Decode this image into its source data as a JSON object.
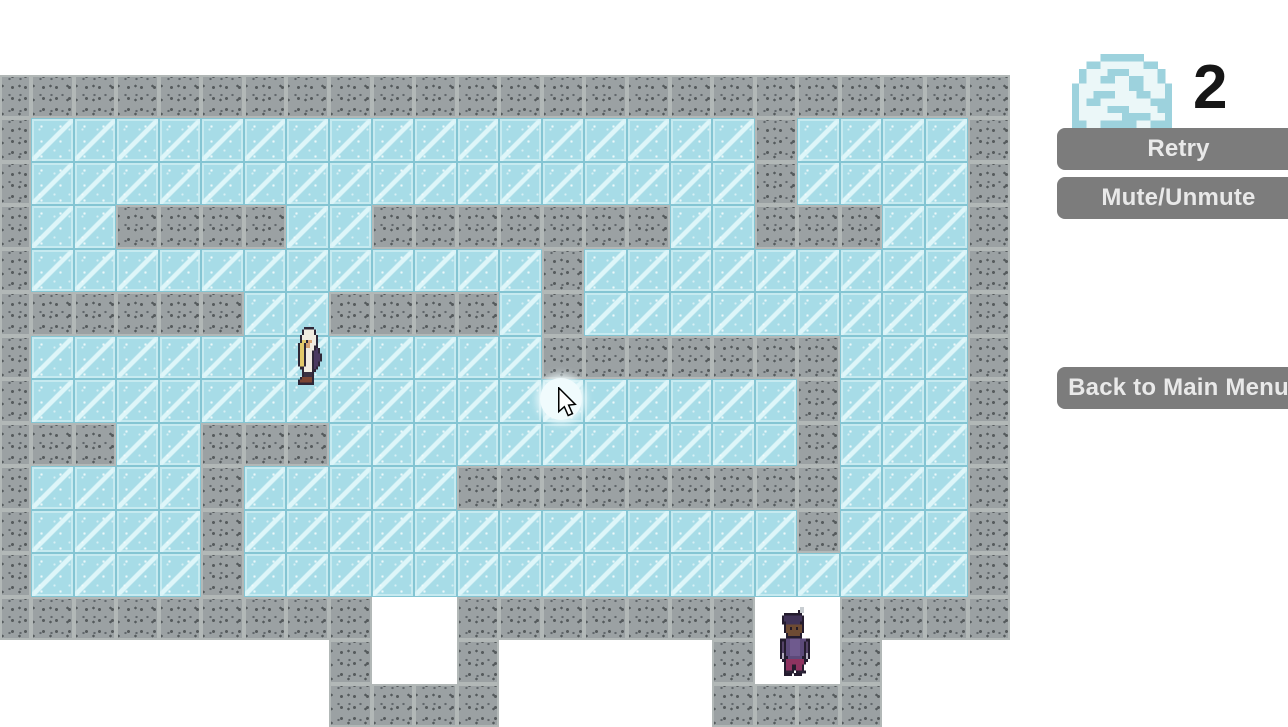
{
  "hud": {
    "level_number": "2",
    "buttons": [
      {
        "id": "retry",
        "label": "Retry"
      },
      {
        "id": "mute",
        "label": "Mute/Unmute"
      },
      {
        "id": "back",
        "label": "Back to Main Menu"
      }
    ],
    "button_color": "#7c7c7c",
    "button_text_color": "#e9e9e9",
    "level_icon": {
      "name": "ice-planet-icon",
      "x": 1072,
      "y": 54,
      "width": 100,
      "height": 74,
      "palette": {
        "B": "#9dd2dd",
        "W": "#ebf7f8"
      },
      "pixels": [
        "....BBBBBB....",
        "..BBWWWWWWBB..",
        ".BWWWBBBWWWWB.",
        ".BWWBBWWBBWWB.",
        "BWWWWWWWBBWWWB",
        "BWWBBBWWWBBWWB",
        "BWBBWWWWWWWBBB",
        "BWWWWBBBWWWWBB",
        "BWWWWWWBBBBWWB",
        "BBWWBBBBBWWBBB"
      ]
    }
  },
  "maze": {
    "origin": {
      "x": 0,
      "y": 75
    },
    "tile": {
      "width": 42.57,
      "height": 43.47,
      "first_col_width": 31
    },
    "legend": {
      "#": "wall",
      ".": "ice",
      " ": "empty"
    },
    "colors": {
      "wall": "#9ba1a3",
      "wall_edge": "#b2b8b7",
      "wall_speckle": "#565b5d",
      "ice": "#a7dce7",
      "ice_edge": "#84c5d3",
      "ice_streak": "#e1f7fa"
    },
    "map": [
      "########################",
      "#.................#....#",
      "#.................#....#",
      "#..####..#######..###..#",
      "#............#.........#",
      "######..####.#.........#",
      "#............#######...#",
      "#..................#...#",
      "###..###...........#...#",
      "#....#.....#########...#",
      "#....#.............#...#",
      "#....#.................#",
      "#########  #######  ####",
      "        #  #     #  #   ",
      "        ####     ####   "
    ]
  },
  "characters": {
    "player": {
      "name": "hooded-explorer",
      "x": 294,
      "y": 327,
      "width": 30,
      "height": 58,
      "palette": {
        "o": "#2e2737",
        "h": "#f1ece1",
        "y": "#e3c96a",
        "s": "#d6a272",
        "p": "#4a3960",
        "k": "#3a3142",
        "b": "#7c4533"
      },
      "pixels": [
        ".....ooooo.....",
        "....ohhhhho....",
        "....ohhhhho....",
        "...ohhhhhhho...",
        "...ohhhhhhho...",
        "...oyyosshho...",
        "..oyyosshhho...",
        "..oyyosshhoo...",
        "..oyyohhhhopo..",
        "..oyyohhhoppo..",
        "..oyyohhhopppo.",
        "..oyyohhhopppo.",
        "..oyyohhhopppo.",
        "..oyyohhhoppo..",
        "..oyyohhhoppo..",
        "...oohhhhopo...",
        "....ohhhhoo....",
        "....okkkko.....",
        "....okkkko.....",
        "...obbbbbo.....",
        "..obbbbbbo.....",
        "..oooooooo....."
      ]
    },
    "npc": {
      "name": "purple-traveler",
      "x": 778,
      "y": 607,
      "width": 34,
      "height": 69,
      "palette": {
        "o": "#241c2e",
        "g": "#c9ced2",
        "c": "#413457",
        "f": "#6e4b33",
        "e": "#241b28",
        "t": "#5c4a7a",
        "m": "#6f5a8e",
        "a": "#554368",
        "n": "#b2abbd",
        "r": "#8f3360",
        "k": "#2c2438"
      },
      "pixels": [
        "...........gg....",
        "..........ogg....",
        "...ooooooooo.....",
        "..occccccccco....",
        "..occccccccco....",
        "..oocccccccoo....",
        "...offffffffo....",
        "...offeffeffo....",
        "...offffffffo....",
        "....offffffo.....",
        "....oooooooo.....",
        ".ooottmmmmmtttoo.",
        ".oaottmmmmmttoao.",
        ".oaottmmmmmttoao.",
        ".oaottmmmmmttoao.",
        ".oaottmmmmmttoao.",
        ".onottmmmmmttono.",
        ".onootttttttoono.",
        "..oorrrrrrrrroo..",
        "...orrrrrrrrro...",
        "...orrroorrro....",
        "...orrroorrro....",
        "...okkko.okkko...",
        "...oooo.oooo....."
      ]
    }
  },
  "cursor": {
    "highlight": {
      "x": 540,
      "y": 378,
      "diameter": 42,
      "color": "#f0fbfd"
    },
    "pointer": {
      "x": 556,
      "y": 387,
      "width": 22,
      "height": 30
    }
  }
}
